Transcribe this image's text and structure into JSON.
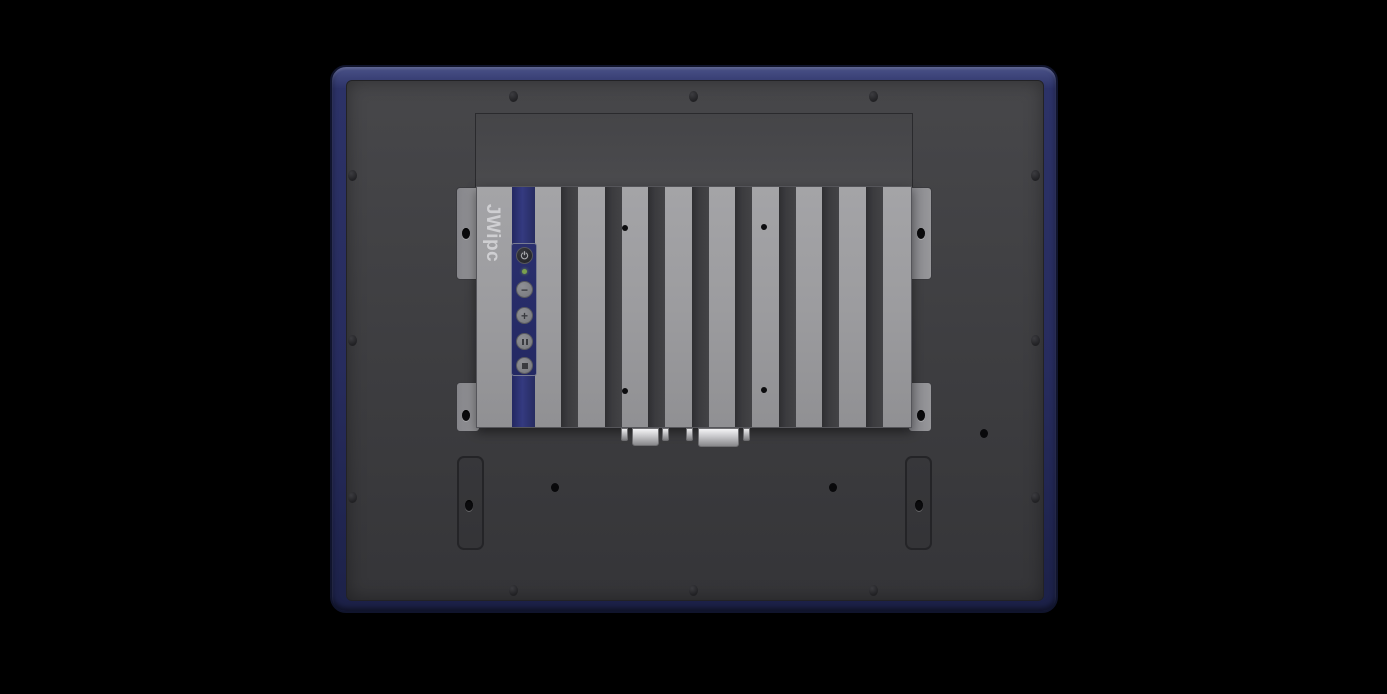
{
  "image": {
    "type": "product-render",
    "subject": "rear view of an industrial panel PC with a finned embedded box PC mounted on the back"
  },
  "brand": {
    "logo_text": "JWipc"
  },
  "colors": {
    "bezel_blue": "#2b3166",
    "back_panel_gray": "#3f3f42",
    "chassis_gray": "#9c9c9f",
    "fin_slot_dark": "#3b3b3e",
    "accent_stripe_blue": "#2d3277",
    "power_led_green": "#7aa04e",
    "connector_silver": "#d6d6d9"
  },
  "osd_controls": {
    "buttons": [
      {
        "name": "power",
        "glyph": "power-symbol"
      },
      {
        "name": "brightness-down",
        "glyph": "−"
      },
      {
        "name": "brightness-up",
        "glyph": "+"
      },
      {
        "name": "menu",
        "glyph": "double-bar"
      },
      {
        "name": "select",
        "glyph": "square"
      }
    ],
    "led": {
      "name": "power-led",
      "state_color": "#7aa04e"
    }
  },
  "heatsink": {
    "fin_slot_count": 8
  },
  "connectors": [
    {
      "name": "serial-db9"
    },
    {
      "name": "vga-db15"
    }
  ]
}
